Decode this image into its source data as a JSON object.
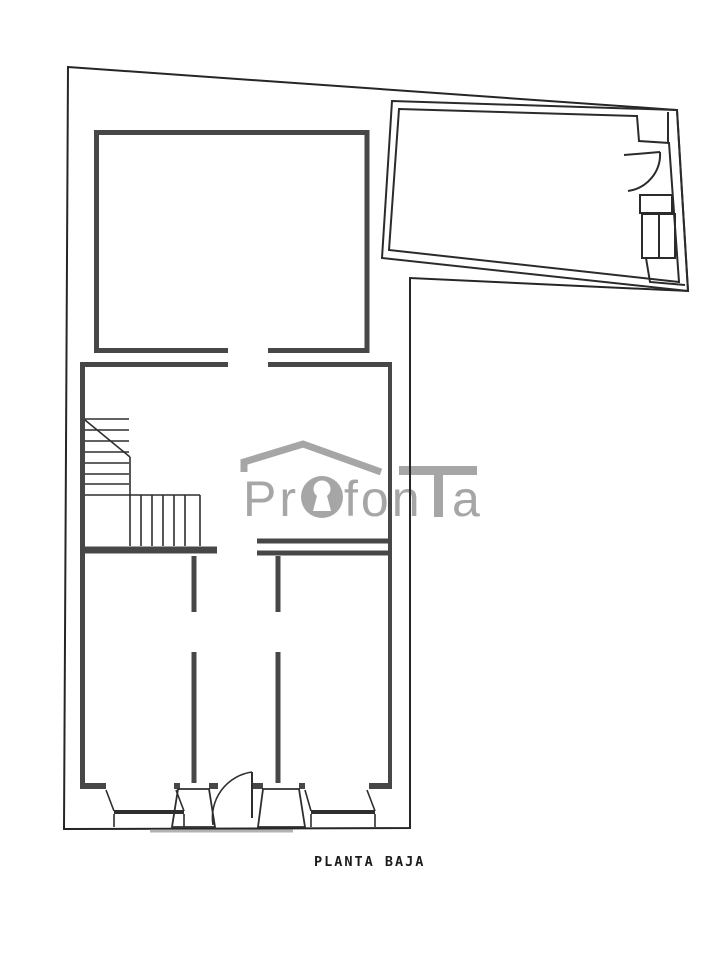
{
  "footer": {
    "title": "PLANTA BAJA"
  },
  "watermark": {
    "text": "Profonta",
    "part1": "Pr",
    "part2": "fon",
    "part3": "a",
    "color": "#a6a6a6",
    "keyhole_fill": "#ffffff"
  },
  "plan": {
    "type": "floor-plan",
    "colors": {
      "boundary": "#262626",
      "wall": "#474747",
      "line": "#2e2e2e",
      "annex": "#2b2b2b",
      "threshold": "#b3b3b3"
    }
  }
}
